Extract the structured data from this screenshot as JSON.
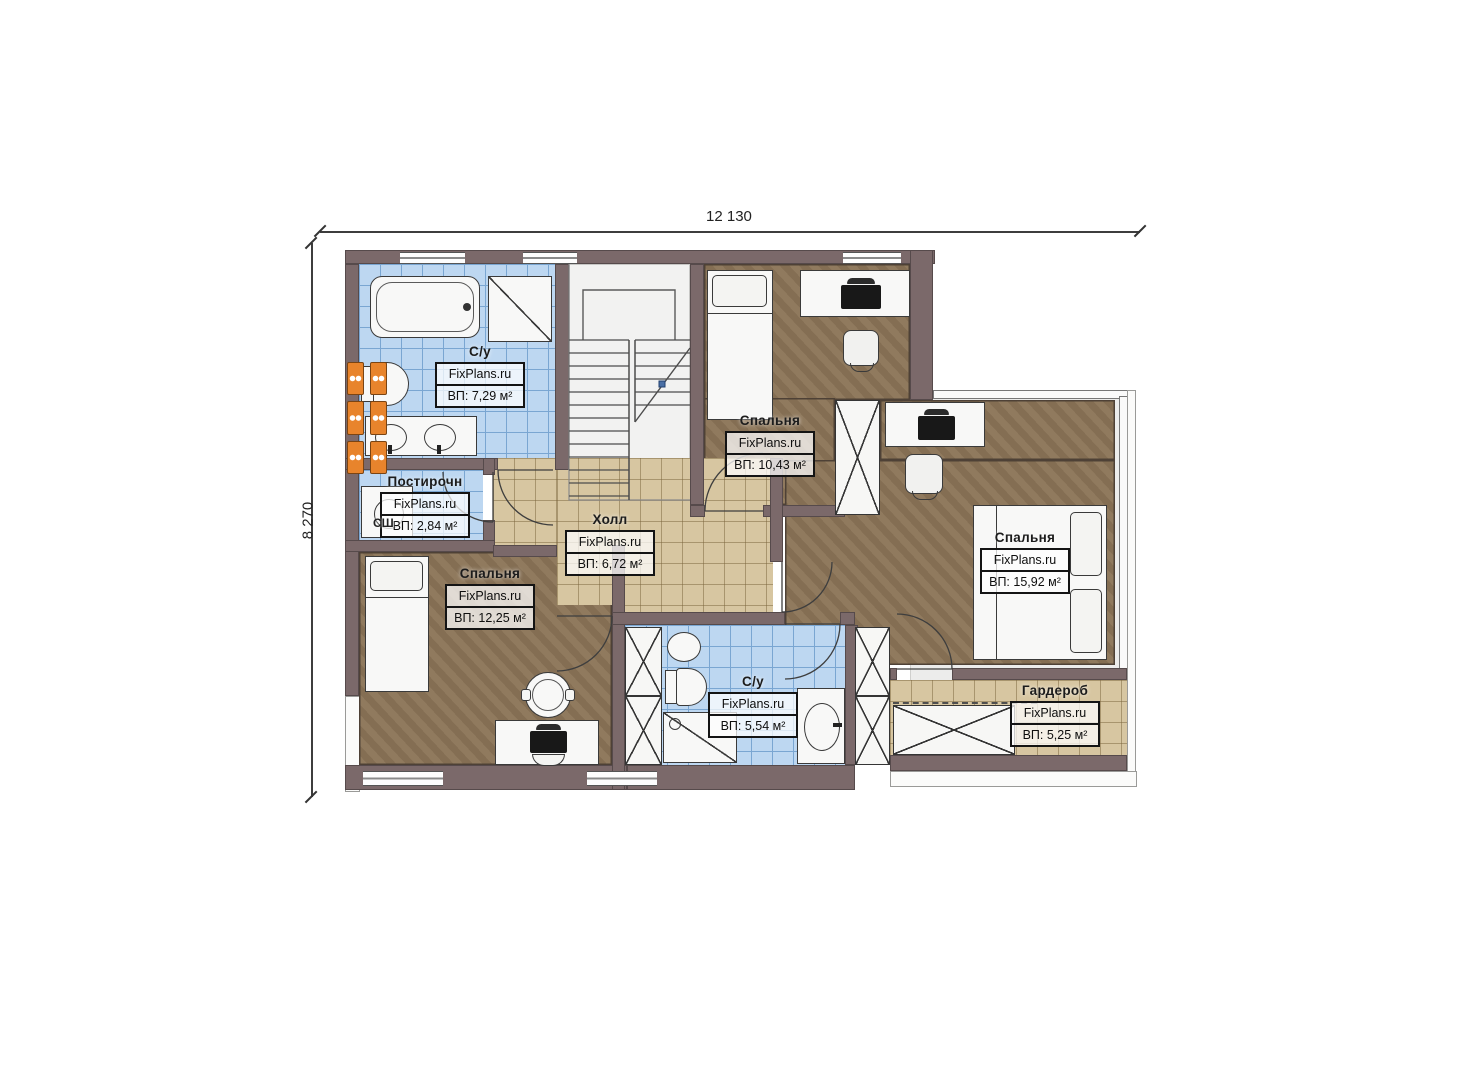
{
  "dimensions": {
    "width_label": "12 130",
    "height_label": "8 270"
  },
  "brand": "FixPlans.ru",
  "rooms": [
    {
      "id": "bath-top",
      "name": "С/у",
      "brand": "FixPlans.ru",
      "area": "ВП: 7,29 м²"
    },
    {
      "id": "laundry",
      "name": "Постирочн",
      "brand": "FixPlans.ru",
      "area": "ВП: 2,84 м²",
      "annotation": "СШ"
    },
    {
      "id": "hall",
      "name": "Холл",
      "brand": "FixPlans.ru",
      "area": "ВП: 6,72 м²"
    },
    {
      "id": "bedroom-top",
      "name": "Спальня",
      "brand": "FixPlans.ru",
      "area": "ВП: 10,43 м²"
    },
    {
      "id": "bedroom-right",
      "name": "Спальня",
      "brand": "FixPlans.ru",
      "area": "ВП: 15,92 м²"
    },
    {
      "id": "bedroom-left",
      "name": "Спальня",
      "brand": "FixPlans.ru",
      "area": "ВП: 12,25 м²"
    },
    {
      "id": "bath-bottom",
      "name": "С/у",
      "brand": "FixPlans.ru",
      "area": "ВП: 5,54 м²"
    },
    {
      "id": "wardrobe",
      "name": "Гардероб",
      "brand": "FixPlans.ru",
      "area": "ВП: 5,25 м²"
    }
  ],
  "colors": {
    "wall": "#7b696a",
    "tile_blue": "#bdd7f1",
    "tile_beige": "#d7c6a1",
    "carpet_brown": "#8b7457",
    "radiator_orange": "#e8842c",
    "stair_marker_blue": "#4a6fa5"
  }
}
